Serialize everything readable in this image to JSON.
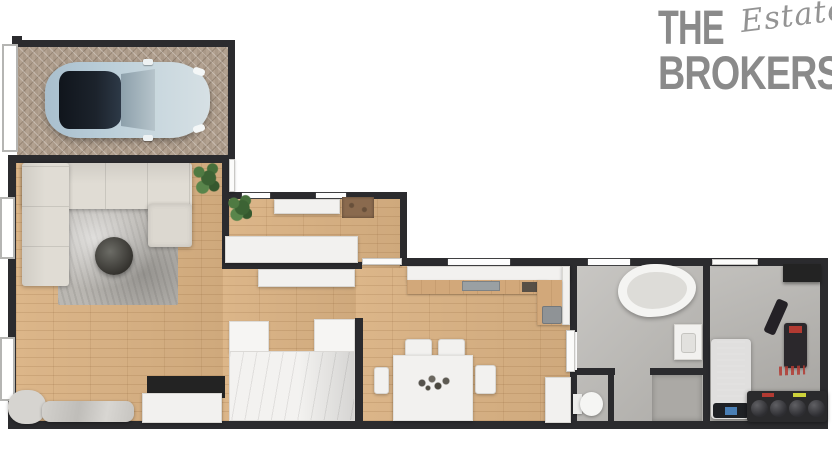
{
  "logo": {
    "word_top": "THE",
    "word_script": "Estate",
    "word_bottom": "BROKERS"
  },
  "palette": {
    "background": "#ffffff",
    "logo_gray": "#8a8a8a",
    "wall": "#2b2b2e",
    "wood_floor": "#dab283",
    "paver_floor": "#b2a190",
    "bathroom_floor": "#bcbab6",
    "gym_floor": "#b7b5b1",
    "sofa": "#e0dcd4",
    "rug": "#bab7b2",
    "car_body": "#b9cdd8",
    "car_roof": "#1c232c",
    "kitchen_worktop": "#d2a87a",
    "white_furniture": "#f2f1ef",
    "plant_green": "#46703b",
    "accent_red": "#b23a32",
    "accent_yellow": "#cdd23a",
    "screen_blue": "#4a7fb5"
  }
}
